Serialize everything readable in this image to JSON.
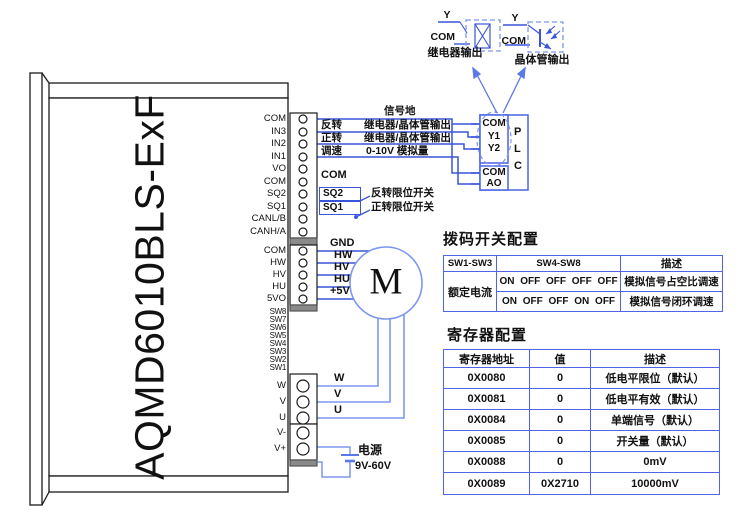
{
  "device": {
    "model": "AQMD6010BLS-ExF",
    "signal_terminals": [
      "COM",
      "IN3",
      "IN2",
      "IN1",
      "VO",
      "COM",
      "SQ2",
      "SQ1",
      "CANL/B",
      "CANH/A"
    ],
    "hall_terminals": [
      "COM",
      "HW",
      "HV",
      "HU",
      "5VO"
    ],
    "dip_switch_labels": [
      "SW8",
      "SW7",
      "SW6",
      "SW5",
      "SW4",
      "SW3",
      "SW2",
      "SW1"
    ],
    "phase_terminals": [
      "W",
      "V",
      "U"
    ],
    "power_terminals": [
      "V-",
      "V+"
    ]
  },
  "legend": {
    "relay": {
      "y": "Y",
      "com": "COM",
      "caption": "继电器输出"
    },
    "transistor": {
      "y": "Y",
      "com": "COM",
      "caption": "晶体管输出"
    }
  },
  "wiring": {
    "signal_ground": "信号地",
    "reverse": {
      "name": "反转",
      "desc": "继电器/晶体管输出"
    },
    "forward": {
      "name": "正转",
      "desc": "继电器/晶体管输出"
    },
    "speed": {
      "name": "调速",
      "desc": "0-10V 模拟量"
    },
    "com": "COM",
    "sq2": {
      "name": "SQ2",
      "desc": "反转限位开关"
    },
    "sq1": {
      "name": "SQ1",
      "desc": "正转限位开关"
    },
    "hall_wire_labels": [
      "GND",
      "HW",
      "HV",
      "HU",
      "+5V"
    ],
    "phase_wire_labels": [
      "W",
      "V",
      "U"
    ]
  },
  "plc": {
    "pins_top": [
      "COM",
      "Y1",
      "Y2"
    ],
    "pins_bottom": [
      "COM",
      "AO"
    ],
    "name_letters": [
      "P",
      "L",
      "C"
    ]
  },
  "motor": {
    "label": "M"
  },
  "power_supply": {
    "label": "电源",
    "voltage": "9V-60V"
  },
  "dip_table": {
    "title": "拨码开关配置",
    "headers": [
      "SW1-SW3",
      "SW4-SW8",
      "描述"
    ],
    "merged_col1": "额定电流",
    "rows": [
      {
        "sw48": "ON OFF OFF OFF OFF",
        "desc": "模拟信号占空比调速"
      },
      {
        "sw48": "ON OFF OFF ON OFF",
        "desc": "模拟信号闭环调速"
      }
    ]
  },
  "register_table": {
    "title": "寄存器配置",
    "headers": [
      "寄存器地址",
      "值",
      "描述"
    ],
    "rows": [
      {
        "addr": "0X0080",
        "value": "0",
        "desc": "低电平限位（默认）"
      },
      {
        "addr": "0X0081",
        "value": "0",
        "desc": "低电平有效（默认）"
      },
      {
        "addr": "0X0084",
        "value": "0",
        "desc": "单端信号（默认）"
      },
      {
        "addr": "0X0085",
        "value": "0",
        "desc": "开关量（默认）"
      },
      {
        "addr": "0X0088",
        "value": "0",
        "desc": "0mV"
      },
      {
        "addr": "0X0089",
        "value": "0X2710",
        "desc": "10000mV"
      }
    ]
  }
}
